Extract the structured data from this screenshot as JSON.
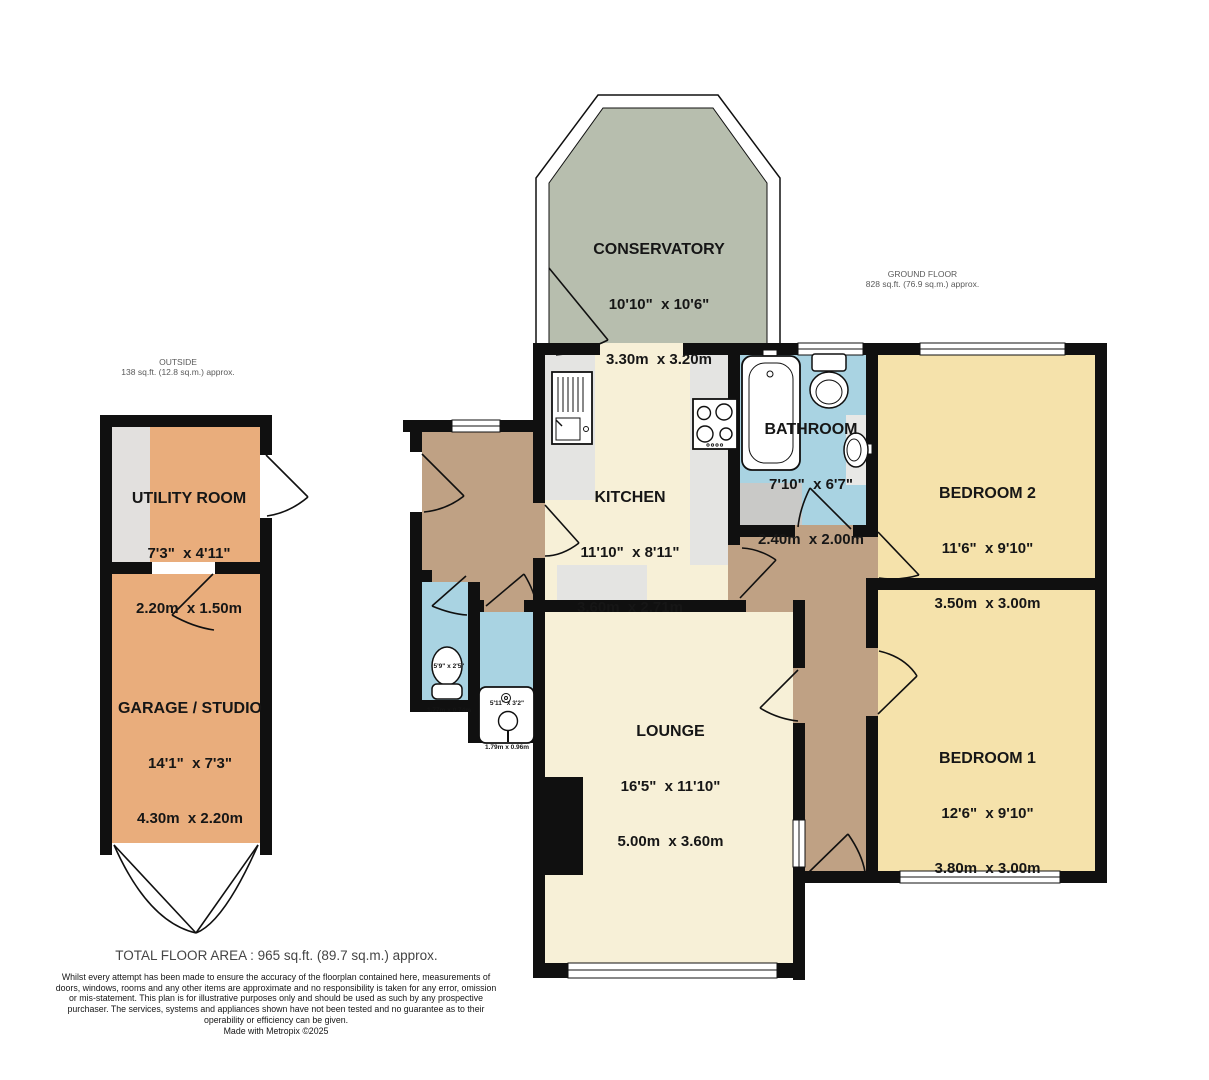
{
  "areas": {
    "outside": {
      "title": "OUTSIDE",
      "area": "138 sq.ft. (12.8 sq.m.) approx."
    },
    "ground": {
      "title": "GROUND FLOOR",
      "area": "828 sq.ft. (76.9 sq.m.) approx."
    }
  },
  "rooms": {
    "conservatory": {
      "name": "CONSERVATORY",
      "imperial": "10'10\"  x 10'6\"",
      "metric": "3.30m  x 3.20m"
    },
    "kitchen": {
      "name": "KITCHEN",
      "imperial": "11'10\"  x 8'11\"",
      "metric": "3.60m  x 2.71m"
    },
    "bathroom": {
      "name": "BATHROOM",
      "imperial": "7'10\"  x 6'7\"",
      "metric": "2.40m  x 2.00m"
    },
    "bedroom2": {
      "name": "BEDROOM 2",
      "imperial": "11'6\"  x 9'10\"",
      "metric": "3.50m  x 3.00m"
    },
    "bedroom1": {
      "name": "BEDROOM 1",
      "imperial": "12'6\"  x 9'10\"",
      "metric": "3.80m  x 3.00m"
    },
    "lounge": {
      "name": "LOUNGE",
      "imperial": "16'5\"  x 11'10\"",
      "metric": "5.00m  x 3.60m"
    },
    "utility": {
      "name": "UTILITY ROOM",
      "imperial": "7'3\"  x 4'11\"",
      "metric": "2.20m  x 1.50m"
    },
    "garage": {
      "name": "GARAGE / STUDIO",
      "imperial": "14'1\"  x 7'3\"",
      "metric": "4.30m  x 2.20m"
    },
    "wc": {
      "imperial": "5'9\" x 2'5\"",
      "metric": "1.77m x 0.74m"
    },
    "shower": {
      "imperial": "5'11\" x 3'2\"",
      "metric": "1.79m x 0.96m"
    }
  },
  "footer": {
    "total": "TOTAL FLOOR AREA : 965 sq.ft. (89.7 sq.m.) approx.",
    "disclaimer": "Whilst every attempt has been made to ensure the accuracy of the floorplan contained here, measurements of doors, windows, rooms and any other items are approximate and no responsibility is taken for any error, omission or mis-statement. This plan is for illustrative purposes only and should be used as such by any prospective purchaser. The services, systems and appliances shown have not been tested and no guarantee as to their operability or efficiency can be given.",
    "credit": "Made with Metropix ©2025"
  },
  "colors": {
    "wall": "#101010",
    "cream": "#f7f0d7",
    "yellow": "#f5e2ab",
    "sage": "#b7beae",
    "blue": "#a9d3e2",
    "brown": "#bfa184",
    "orange": "#e9ad7c",
    "counter": "#e4e4e2"
  }
}
